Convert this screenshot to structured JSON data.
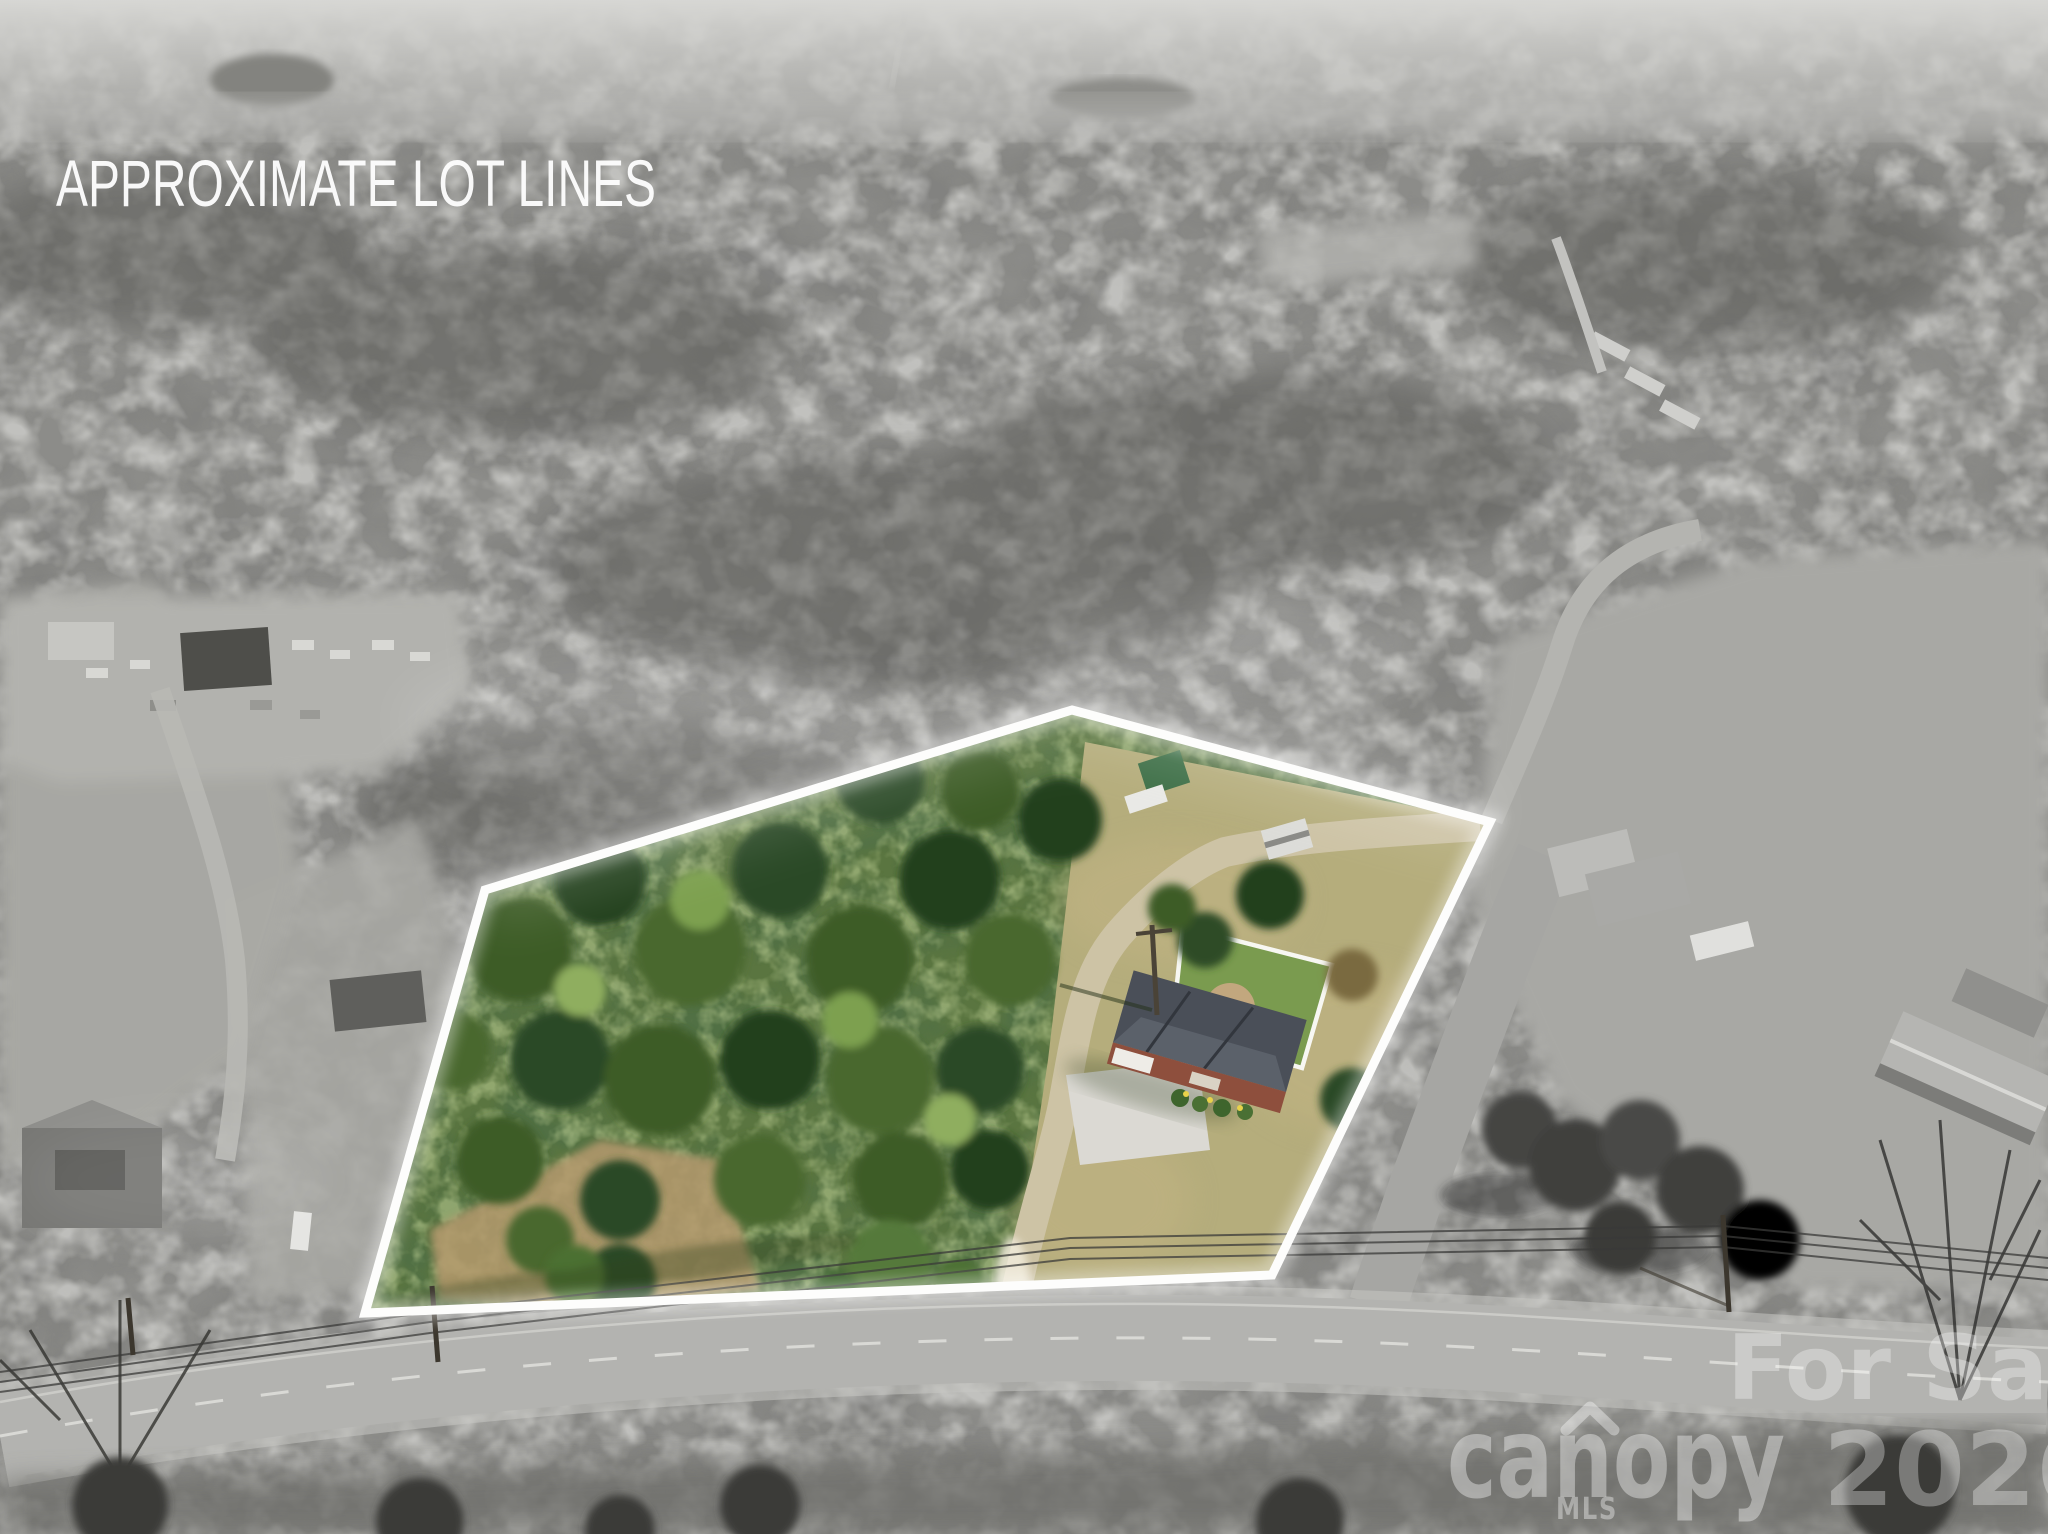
{
  "overlay": {
    "title": "APPROXIMATE LOT LINES"
  },
  "lot": {
    "polygon_points": "1072,710 1490,822 1272,1275 365,1313 485,890",
    "outline_color": "#ffffff"
  },
  "watermark": {
    "listing_status": "For Sale",
    "year": "2026",
    "brand": "canopy",
    "brand_sub": "MLS",
    "color": "#ffffff"
  },
  "icons": {
    "canopy_caret": "roof-caret-icon"
  },
  "palette": {
    "photo_gray": "#8c8c89",
    "sky_haze": "#d2d2cf",
    "lot_green": "#5a7540",
    "lawn_tan": "#b5ad7c",
    "road_gray": "#b3b3b0",
    "gravel_tan": "#cdc3a5",
    "house_roof": "#4a4f58",
    "house_brick": "#8e4f3d",
    "fence_white": "#f7f7f2",
    "outline_white": "#ffffff"
  }
}
